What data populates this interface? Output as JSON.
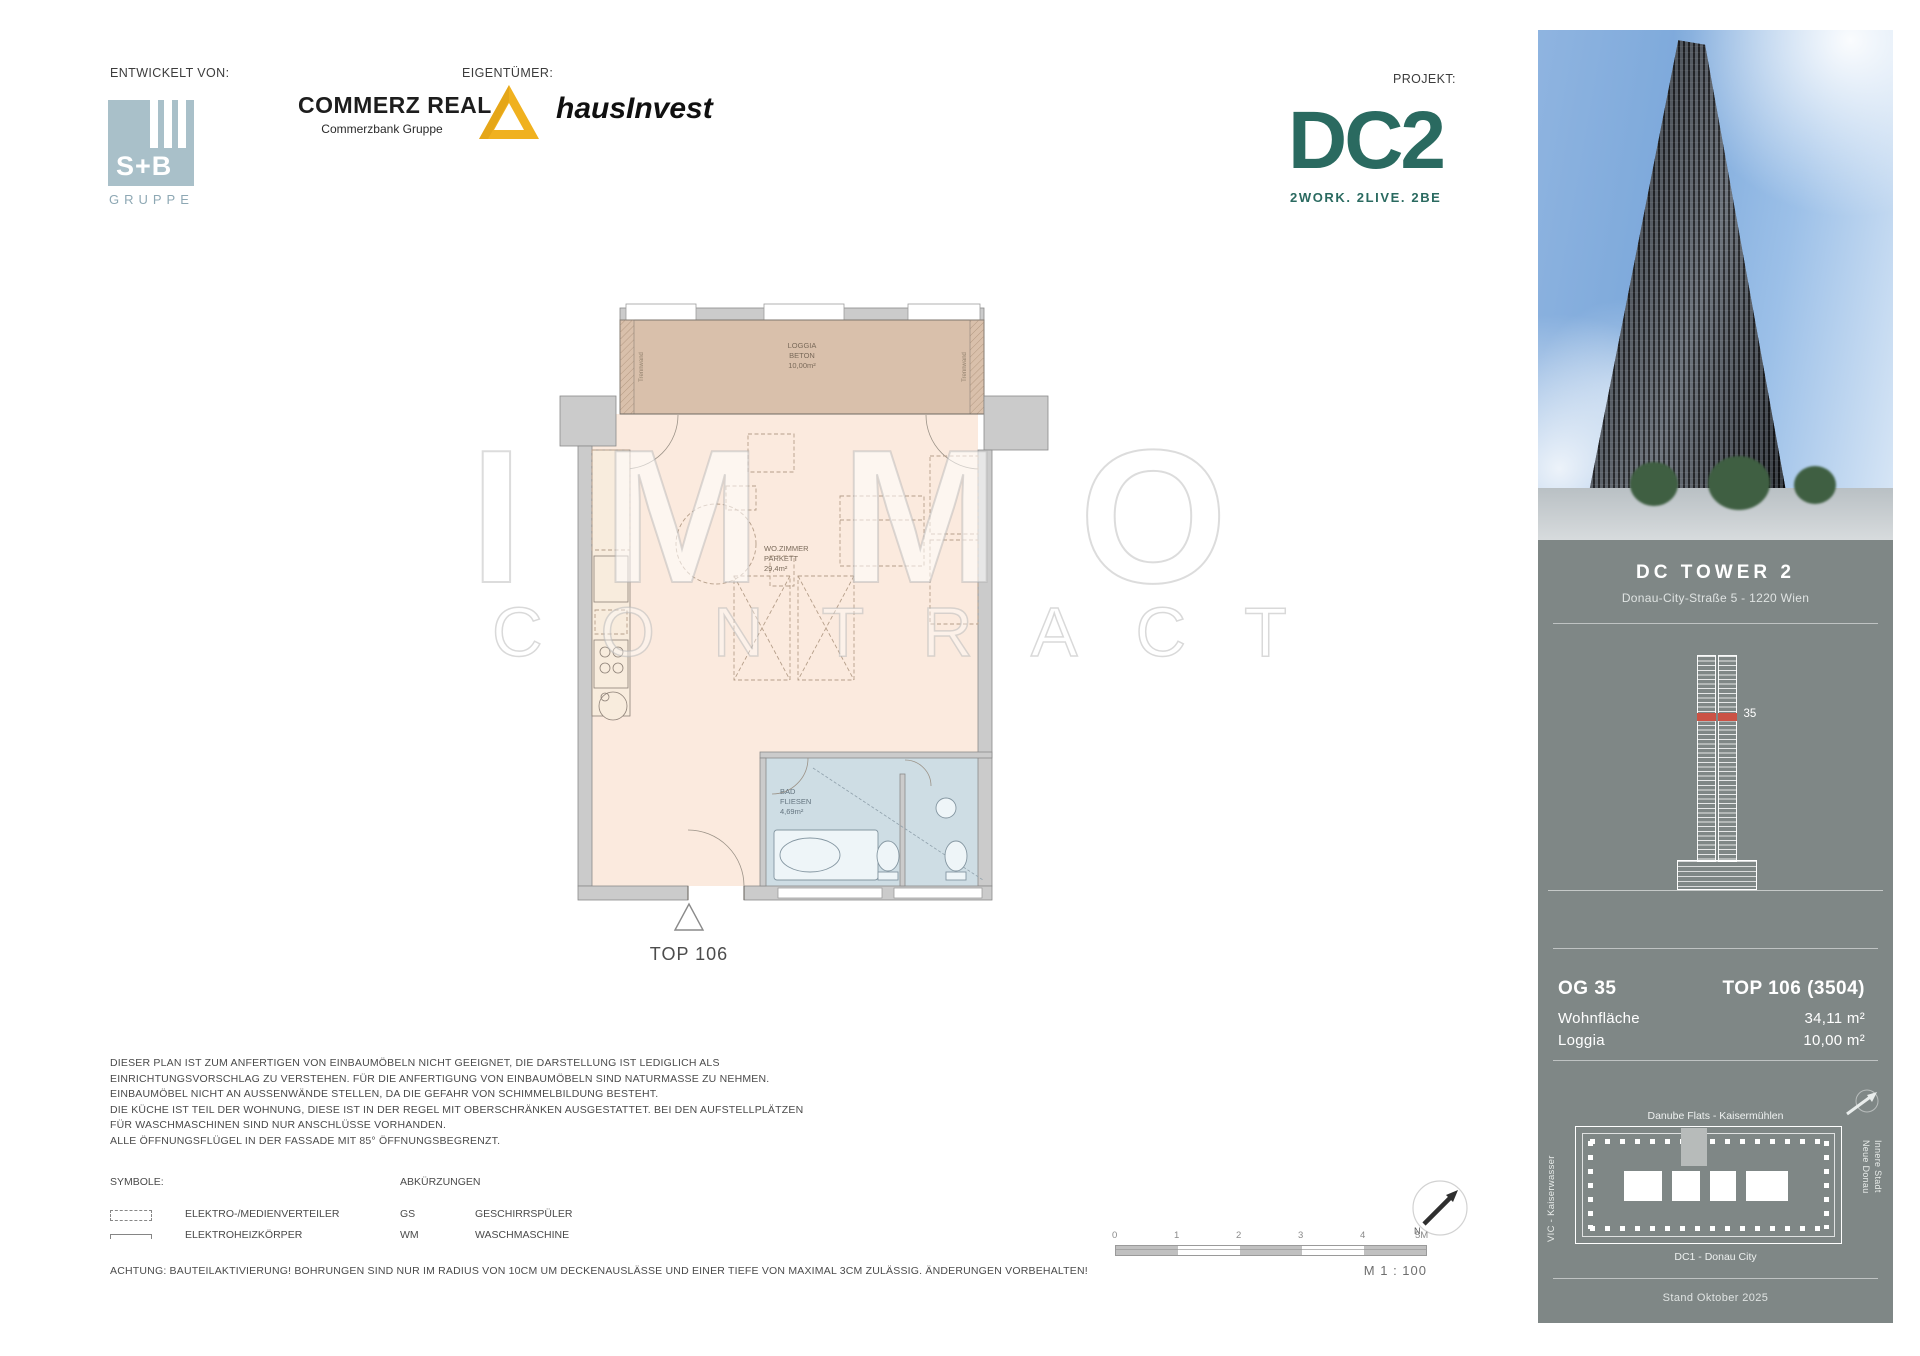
{
  "header": {
    "developed_by_label": "ENTWICKELT VON:",
    "owner_label": "EIGENTÜMER:",
    "project_label": "PROJEKT:",
    "sb_logo": {
      "name": "S+B",
      "group": "GRUPPE"
    },
    "commerz_real": {
      "name": "COMMERZ REAL",
      "subtitle": "Commerzbank Gruppe"
    },
    "hausinvest": {
      "name": "hausInvest"
    },
    "dc2": {
      "name": "DC2",
      "tagline": "2WORK. 2LIVE. 2BE"
    }
  },
  "floorplan": {
    "loggia": {
      "room": "LOGGIA",
      "floor": "BETON",
      "area": "10,00m²"
    },
    "living": {
      "room": "WO.ZIMMER",
      "floor": "PARKETT",
      "area": "29,4m²"
    },
    "bath": {
      "room": "BAD",
      "floor": "FLIESEN",
      "area": "4,69m²"
    },
    "partition_label_left": "Trennwand",
    "partition_label_right": "Trennwand",
    "unit_label": "TOP 106"
  },
  "watermark": {
    "line1": "IMMO",
    "line2": "CONTRACT"
  },
  "sidebar": {
    "title": "DC TOWER 2",
    "address": "Donau-City-Straße 5 - 1220 Wien",
    "tower_floor_marker": "35",
    "unit_info": {
      "floor": "OG 35",
      "top": "TOP 106 (3504)",
      "rows": [
        {
          "label": "Wohnfläche",
          "value": "34,11 m²"
        },
        {
          "label": "Loggia",
          "value": "10,00 m²"
        }
      ]
    },
    "siteplan": {
      "north_label": "Danube Flats - Kaisermühlen",
      "west_label": "VIC - Kaiserwasser",
      "east_label_1": "Neue Donau",
      "east_label_2": "Innere Stadt",
      "south_label": "DC1 - Donau City"
    },
    "date_label": "Stand Oktober 2025"
  },
  "notes": {
    "lines": [
      "DIESER PLAN IST ZUM ANFERTIGEN VON EINBAUMÖBELN NICHT GEEIGNET, DIE DARSTELLUNG IST LEDIGLICH ALS",
      "EINRICHTUNGSVORSCHLAG ZU VERSTEHEN. FÜR DIE ANFERTIGUNG VON EINBAUMÖBELN SIND NATURMASSE ZU NEHMEN.",
      "EINBAUMÖBEL NICHT AN AUSSENWÄNDE STELLEN, DA DIE GEFAHR VON SCHIMMELBILDUNG BESTEHT.",
      "DIE KÜCHE IST TEIL DER WOHNUNG, DIESE IST IN DER REGEL MIT OBERSCHRÄNKEN AUSGESTATTET. BEI DEN AUFSTELLPLÄTZEN",
      "FÜR WASCHMASCHINEN SIND NUR ANSCHLÜSSE VORHANDEN.",
      "ALLE ÖFFNUNGSFLÜGEL IN DER FASSADE MIT 85° ÖFFNUNGSBEGRENZT."
    ]
  },
  "legend": {
    "symbols_label": "SYMBOLE:",
    "abbreviations_label": "ABKÜRZUNGEN",
    "symbols": [
      {
        "label": "ELEKTRO-/MEDIENVERTEILER"
      },
      {
        "label": "ELEKTROHEIZKÖRPER"
      }
    ],
    "abbreviations": [
      {
        "abbr": "GS",
        "label": "GESCHIRRSPÜLER"
      },
      {
        "abbr": "WM",
        "label": "WASCHMASCHINE"
      }
    ],
    "warning": "ACHTUNG: BAUTEILAKTIVIERUNG! BOHRUNGEN SIND NUR IM RADIUS VON 10CM UM DECKENAUSLÄSSE UND EINER TIEFE VON MAXIMAL 3CM ZULÄSSIG. ÄNDERUNGEN VORBEHALTEN!"
  },
  "scalebar": {
    "ticks": [
      "0",
      "1",
      "2",
      "3",
      "4",
      "5M"
    ],
    "scale_label": "M 1 : 100",
    "north_label": "N"
  },
  "colors": {
    "sidebar_bg": "#7f8786",
    "dc2_teal": "#2a6a60",
    "commerz_yellow": "#f0b11f",
    "sb_blue": "#a9c0c9",
    "floor_marker_red": "#cb5245",
    "loggia_fill": "#d9c0ab",
    "room_fill": "#fbeade",
    "bath_fill": "#cedde4",
    "wall_fill": "#cbcbcb"
  }
}
